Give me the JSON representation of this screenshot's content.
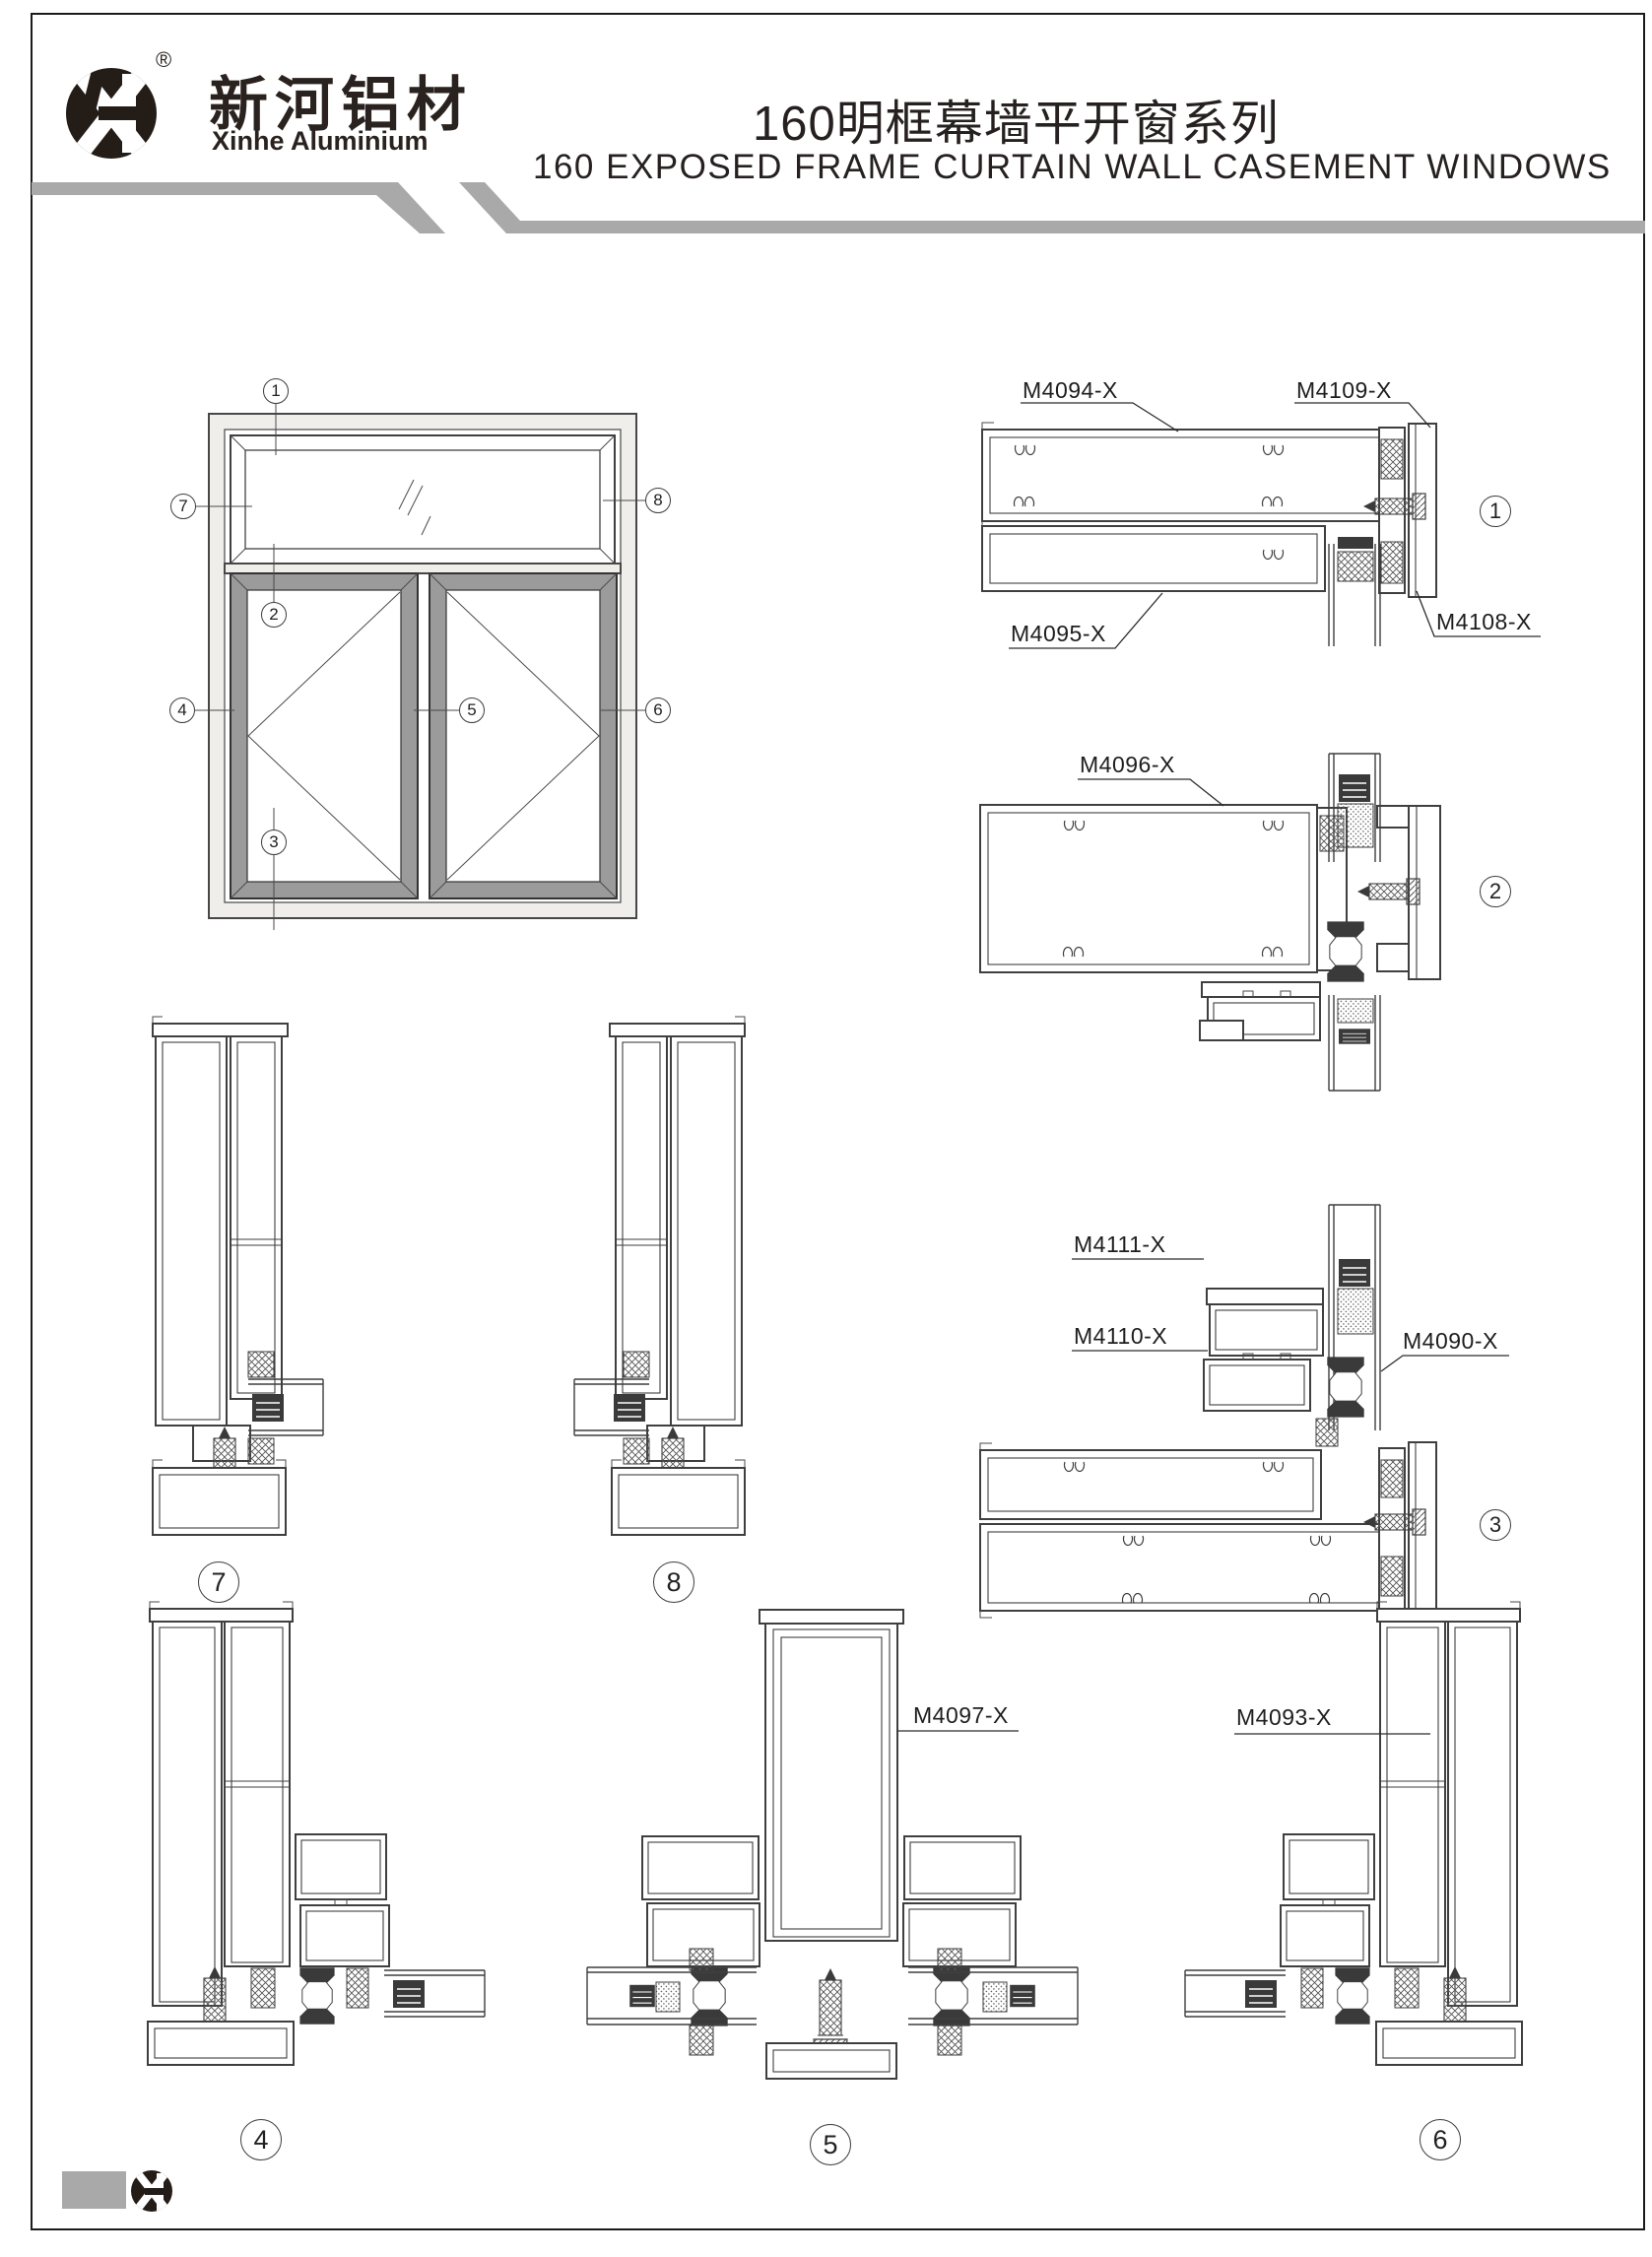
{
  "header": {
    "logo": {
      "symbol": "XH",
      "registered": "®",
      "brand_cn": "新河铝材",
      "brand_en": "Xinhe Aluminium"
    },
    "title_cn": "160明框幕墙平开窗系列",
    "title_en": "160 EXPOSED FRAME CURTAIN WALL CASEMENT WINDOWS"
  },
  "colors": {
    "stripe_gray": "#a9a9a9",
    "line": "#3f3f3f",
    "casement_frame_gray": "#9b9b9b",
    "wall_fill": "#efeeeb",
    "text": "#1f1c1a"
  },
  "elevation": {
    "callouts": {
      "c1": "1",
      "c2": "2",
      "c3": "3",
      "c4": "4",
      "c5": "5",
      "c6": "6",
      "c7": "7",
      "c8": "8"
    }
  },
  "details": {
    "markers": {
      "d1": "1",
      "d2": "2",
      "d3": "3",
      "d4": "4",
      "d5": "5",
      "d6": "6",
      "d7": "7",
      "d8": "8"
    },
    "labels": {
      "m4094": "M4094-X",
      "m4109": "M4109-X",
      "m4095": "M4095-X",
      "m4108": "M4108-X",
      "m4096": "M4096-X",
      "m4111": "M4111-X",
      "m4110": "M4110-X",
      "m4090": "M4090-X",
      "m4097": "M4097-X",
      "m4093": "M4093-X"
    }
  },
  "footer": {
    "logo_symbol": "XH"
  }
}
